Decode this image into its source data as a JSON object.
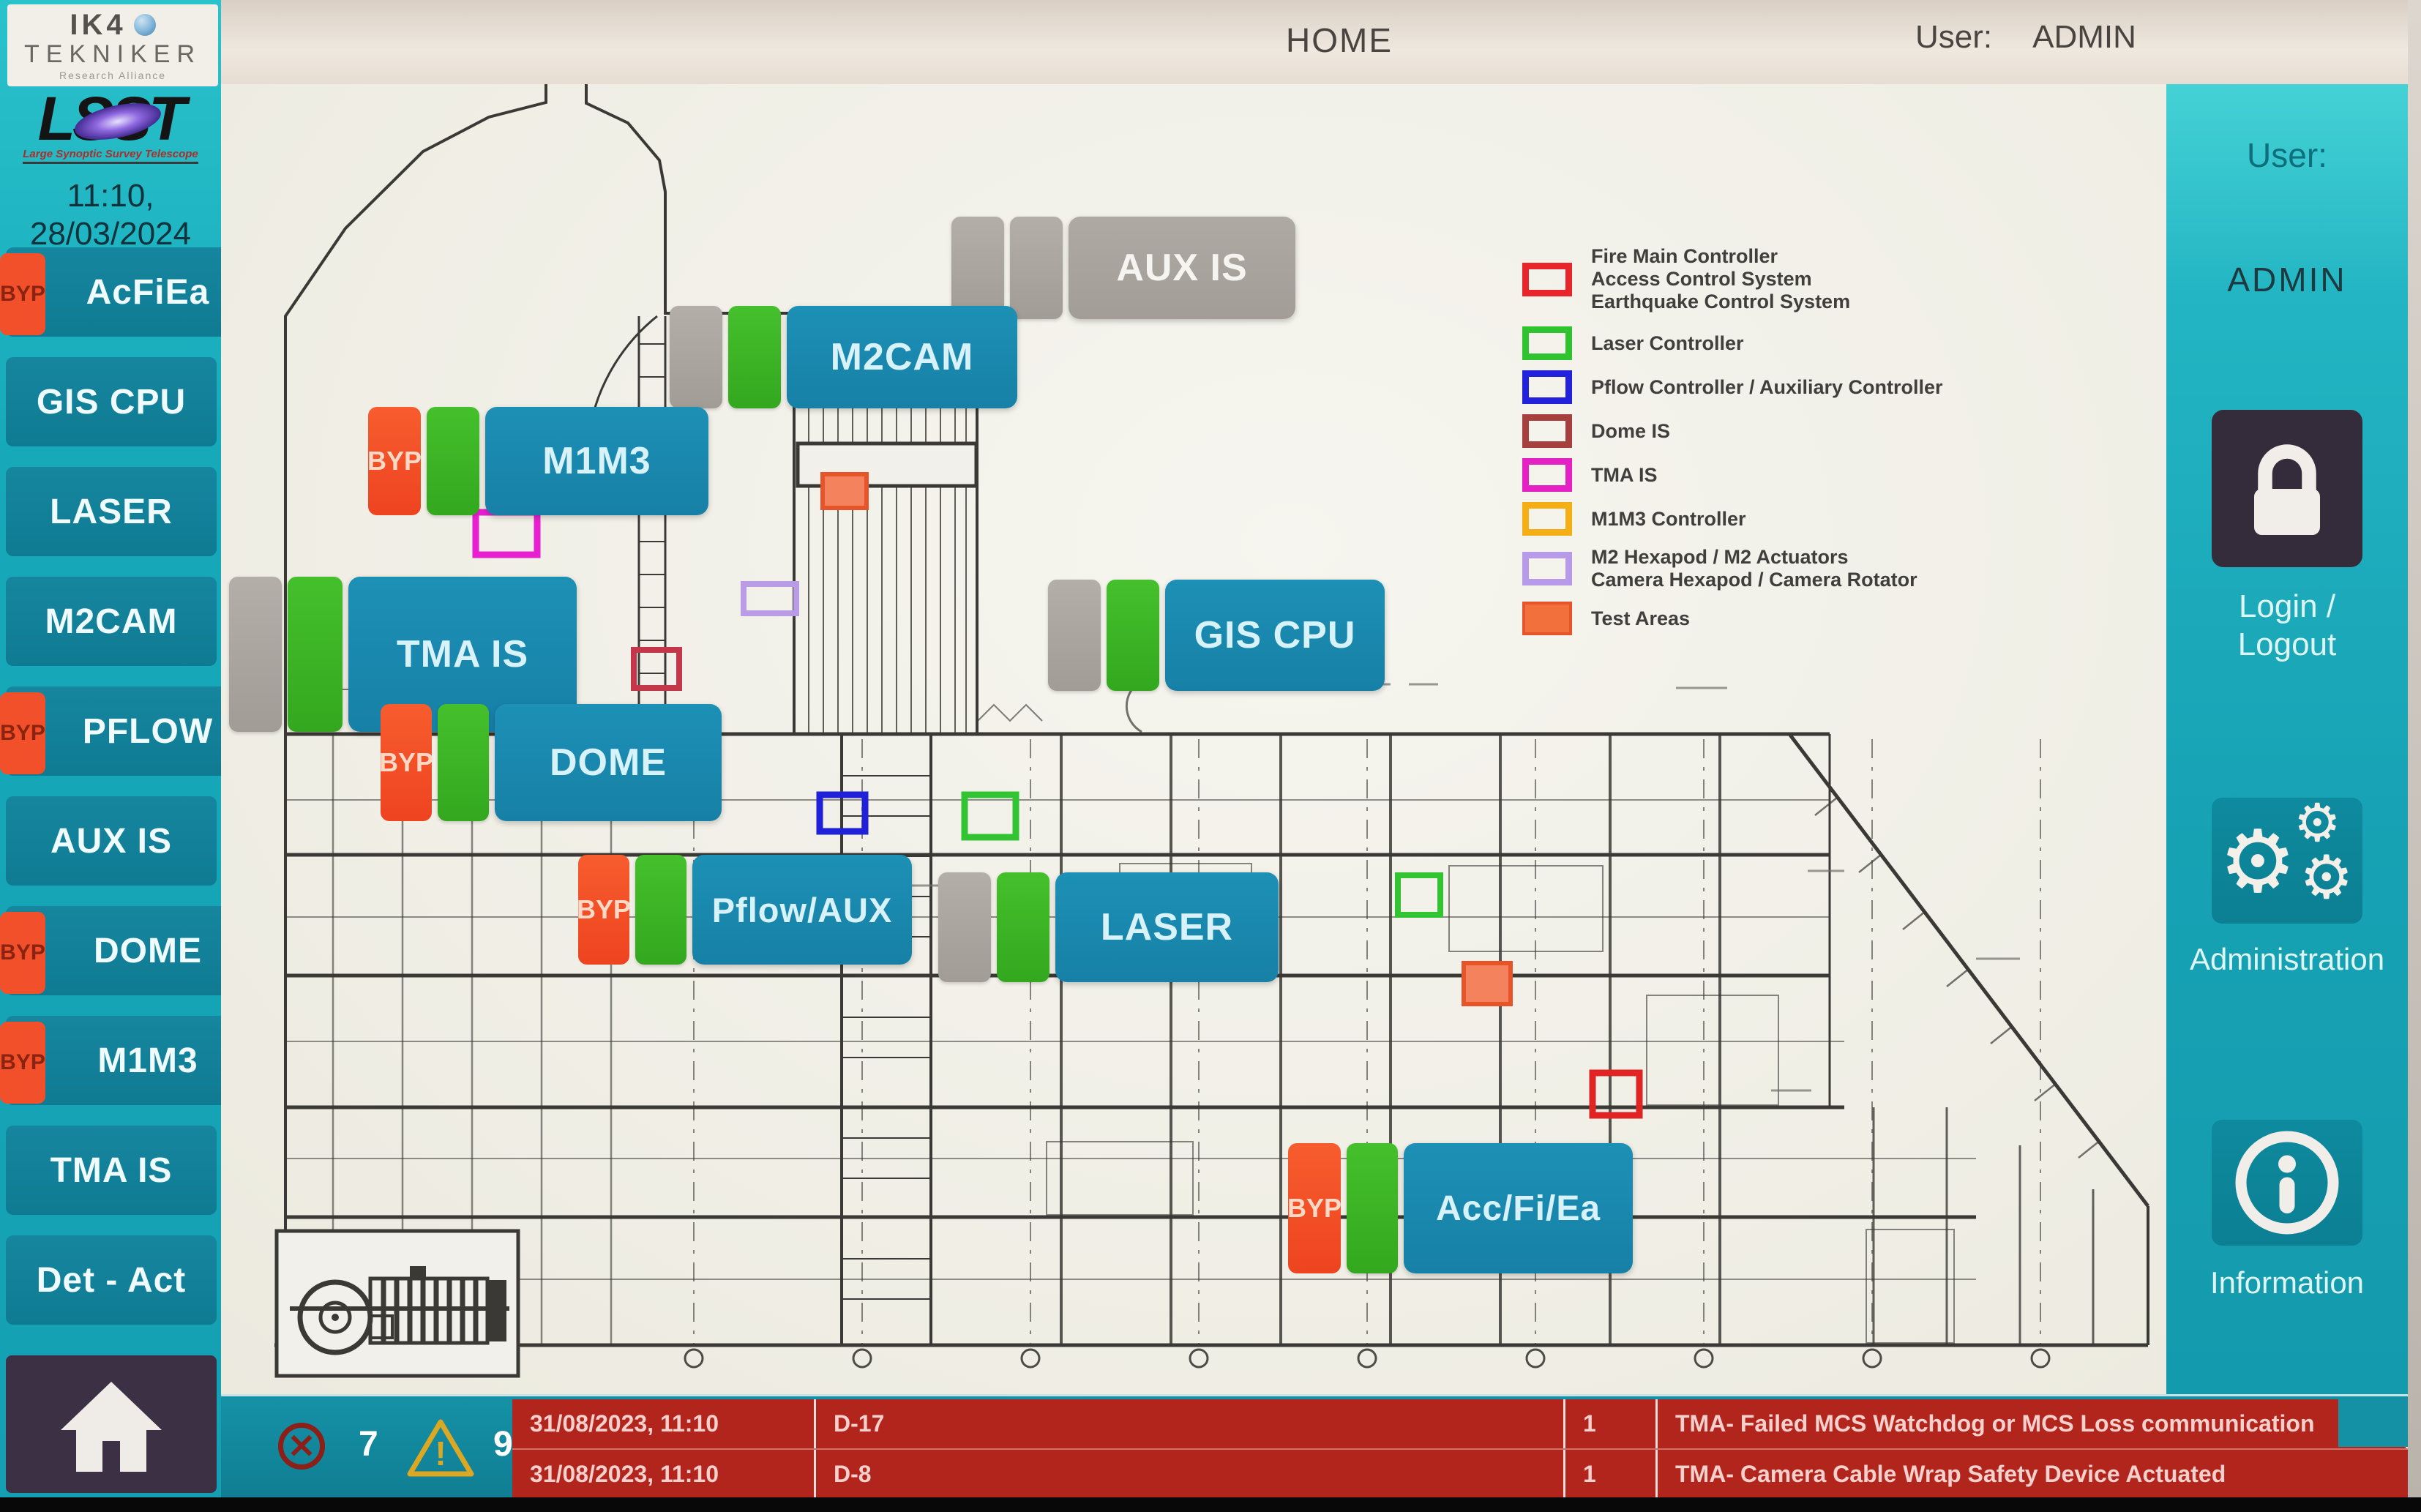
{
  "header": {
    "title": "HOME",
    "user_label": "User:",
    "user_value": "ADMIN"
  },
  "branding": {
    "ik4_top": "IK4",
    "ik4_bottom": "TEKNIKER",
    "ik4_tagline": "Research Alliance",
    "lsst_wordmark": "LSST",
    "lsst_caption": "Large Synoptic Survey Telescope",
    "datetime_line1": "11:10,",
    "datetime_line2": "28/03/2024"
  },
  "sidebar": {
    "byp_label": "BYP",
    "items": [
      {
        "label": "AcFiEa",
        "byp": true
      },
      {
        "label": "GIS CPU",
        "byp": false
      },
      {
        "label": "LASER",
        "byp": false
      },
      {
        "label": "M2CAM",
        "byp": false
      },
      {
        "label": "PFLOW",
        "byp": true
      },
      {
        "label": "AUX IS",
        "byp": false
      },
      {
        "label": "DOME",
        "byp": true
      },
      {
        "label": "M1M3",
        "byp": true
      },
      {
        "label": "TMA IS",
        "byp": false
      },
      {
        "label": "Det - Act",
        "byp": false
      }
    ]
  },
  "diagram": {
    "byp_label": "BYP",
    "buttons": [
      {
        "label": "AUX IS",
        "state": "offline"
      },
      {
        "label": "M2CAM",
        "state": "online"
      },
      {
        "label": "M1M3",
        "state": "online-bypassed"
      },
      {
        "label": "TMA IS",
        "state": "online"
      },
      {
        "label": "GIS CPU",
        "state": "online"
      },
      {
        "label": "DOME",
        "state": "online-bypassed"
      },
      {
        "label": "Pflow/AUX",
        "state": "online-bypassed"
      },
      {
        "label": "LASER",
        "state": "online"
      },
      {
        "label": "Acc/Fi/Ea",
        "state": "online-bypassed"
      }
    ]
  },
  "legend": {
    "items": [
      {
        "color": "#e8252a",
        "filled": false,
        "lines": [
          "Fire Main Controller",
          "Access Control System",
          "Earthquake Control System"
        ]
      },
      {
        "color": "#2fc32f",
        "filled": false,
        "lines": [
          "Laser Controller"
        ]
      },
      {
        "color": "#2222dd",
        "filled": false,
        "lines": [
          "Pflow Controller / Auxiliary Controller"
        ]
      },
      {
        "color": "#a5403f",
        "filled": false,
        "lines": [
          "Dome IS"
        ]
      },
      {
        "color": "#e520c5",
        "filled": false,
        "lines": [
          "TMA IS"
        ]
      },
      {
        "color": "#f5af14",
        "filled": false,
        "lines": [
          "M1M3 Controller"
        ]
      },
      {
        "color": "#b79ae8",
        "filled": false,
        "lines": [
          "M2 Hexapod / M2 Actuators",
          "Camera Hexapod / Camera Rotator"
        ]
      },
      {
        "color": "#f2703c",
        "filled": true,
        "lines": [
          "Test Areas"
        ]
      }
    ]
  },
  "right_sidebar": {
    "user_label": "User:",
    "user_value": "ADMIN",
    "login_label": "Login / Logout",
    "admin_label": "Administration",
    "info_label": "Information"
  },
  "status_bar": {
    "error_count": "7",
    "warning_count": "9",
    "alarms": [
      {
        "date": "31/08/2023, 11:10",
        "zone": "D-17",
        "count": "1",
        "message": "TMA- Failed MCS Watchdog or MCS Loss communication"
      },
      {
        "date": "31/08/2023, 11:10",
        "zone": "D-8",
        "count": "1",
        "message": "TMA- Camera Cable Wrap Safety Device Actuated"
      }
    ]
  }
}
